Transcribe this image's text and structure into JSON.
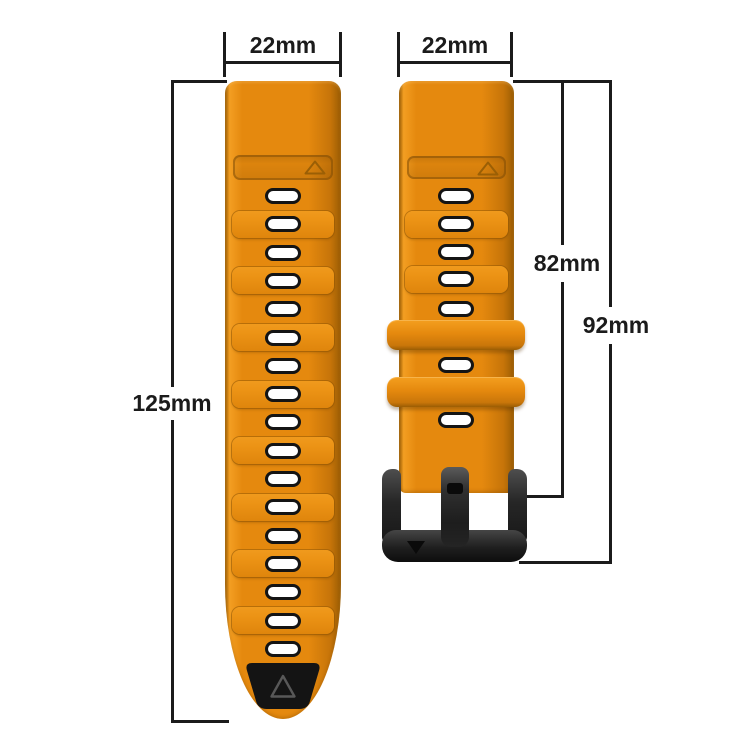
{
  "diagram": {
    "description": "Orange silicone watch strap with black buckle, dimension diagram",
    "labels": {
      "left_strap_width": "22mm",
      "right_strap_width": "22mm",
      "left_strap_length": "125mm",
      "right_strap_length_to_buckle": "82mm",
      "right_strap_total_length": "92mm"
    },
    "colors": {
      "strap_orange": "#E5890E",
      "strap_orange_light": "#F39E22",
      "strap_orange_dark": "#C67409",
      "strap_orange_deep": "#9A5D04",
      "ridge_band": "#EC9315",
      "hole_fill": "#FFFFFF",
      "hole_border": "#141414",
      "tip_black": "#141414",
      "buckle_black": "#181818",
      "dimension_line": "#1B1B1B",
      "background": "#FFFFFF"
    },
    "left_strap": {
      "hole_count": 17,
      "ridge_band_count": 8,
      "markers": [
        "triangle-up-outline",
        "black-tip-triangle-outline"
      ]
    },
    "right_strap": {
      "hole_count": 7,
      "ridge_band_count": 2,
      "keeper_count": 2,
      "markers": [
        "triangle-up-outline",
        "buckle-triangle-down-filled"
      ]
    }
  }
}
